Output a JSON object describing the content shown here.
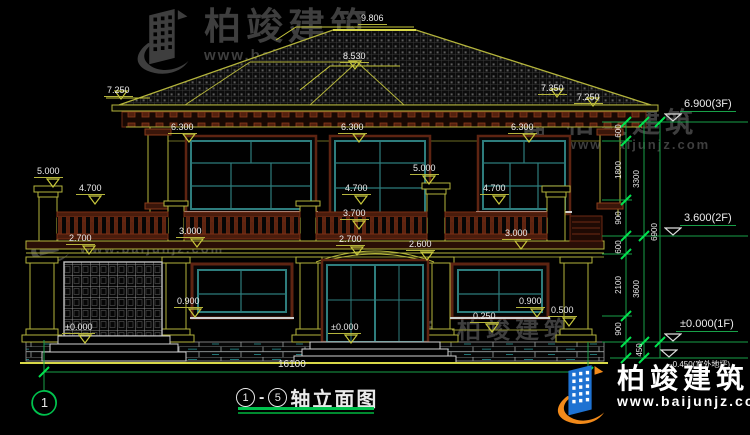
{
  "brand": {
    "name": "柏竣建筑",
    "url": "www.baijunjz.com"
  },
  "title": {
    "axis_start": "1",
    "dash": "-",
    "axis_end": "5",
    "text": "轴立面图"
  },
  "axis_bubble": "1",
  "dims": {
    "roof_apex": "9.806",
    "roof_ridge": "8.530",
    "eave_left": "7.250",
    "ridge_right": "7.350",
    "eave_right": "7.250",
    "lintel2f_a": "6.300",
    "lintel2f_b": "6.300",
    "lintel2f_c": "6.300",
    "post_left": "5.000",
    "post_right": "5.000",
    "rail_left": "4.700",
    "rail_center": "4.700",
    "rail_right": "4.700",
    "balcony_floor": "3.700",
    "slab_left": "3.000",
    "slab_right": "3.000",
    "arch_left": "2.700",
    "arch_center": "2.700",
    "spring_right": "2.600",
    "sill_left": "0.900",
    "sill_right": "0.900",
    "plinth_right": "0.250",
    "plinth_edge": "0.500",
    "zero_left": "±0.000",
    "zero_center": "±0.000",
    "total_width": "16100"
  },
  "levels": {
    "l3f": "6.900(3F)",
    "l2f": "3.600(2F)",
    "l1f": "±0.000(1F)",
    "ground": "-0.450(室外地坪)"
  },
  "chain": {
    "col1": [
      "600",
      "1800",
      "900",
      "600",
      "2100",
      "900",
      "450"
    ],
    "col2": [
      "3300",
      "3600"
    ],
    "col3": [
      "6900"
    ]
  },
  "icons": {
    "logo": "building-swoosh-logo"
  }
}
